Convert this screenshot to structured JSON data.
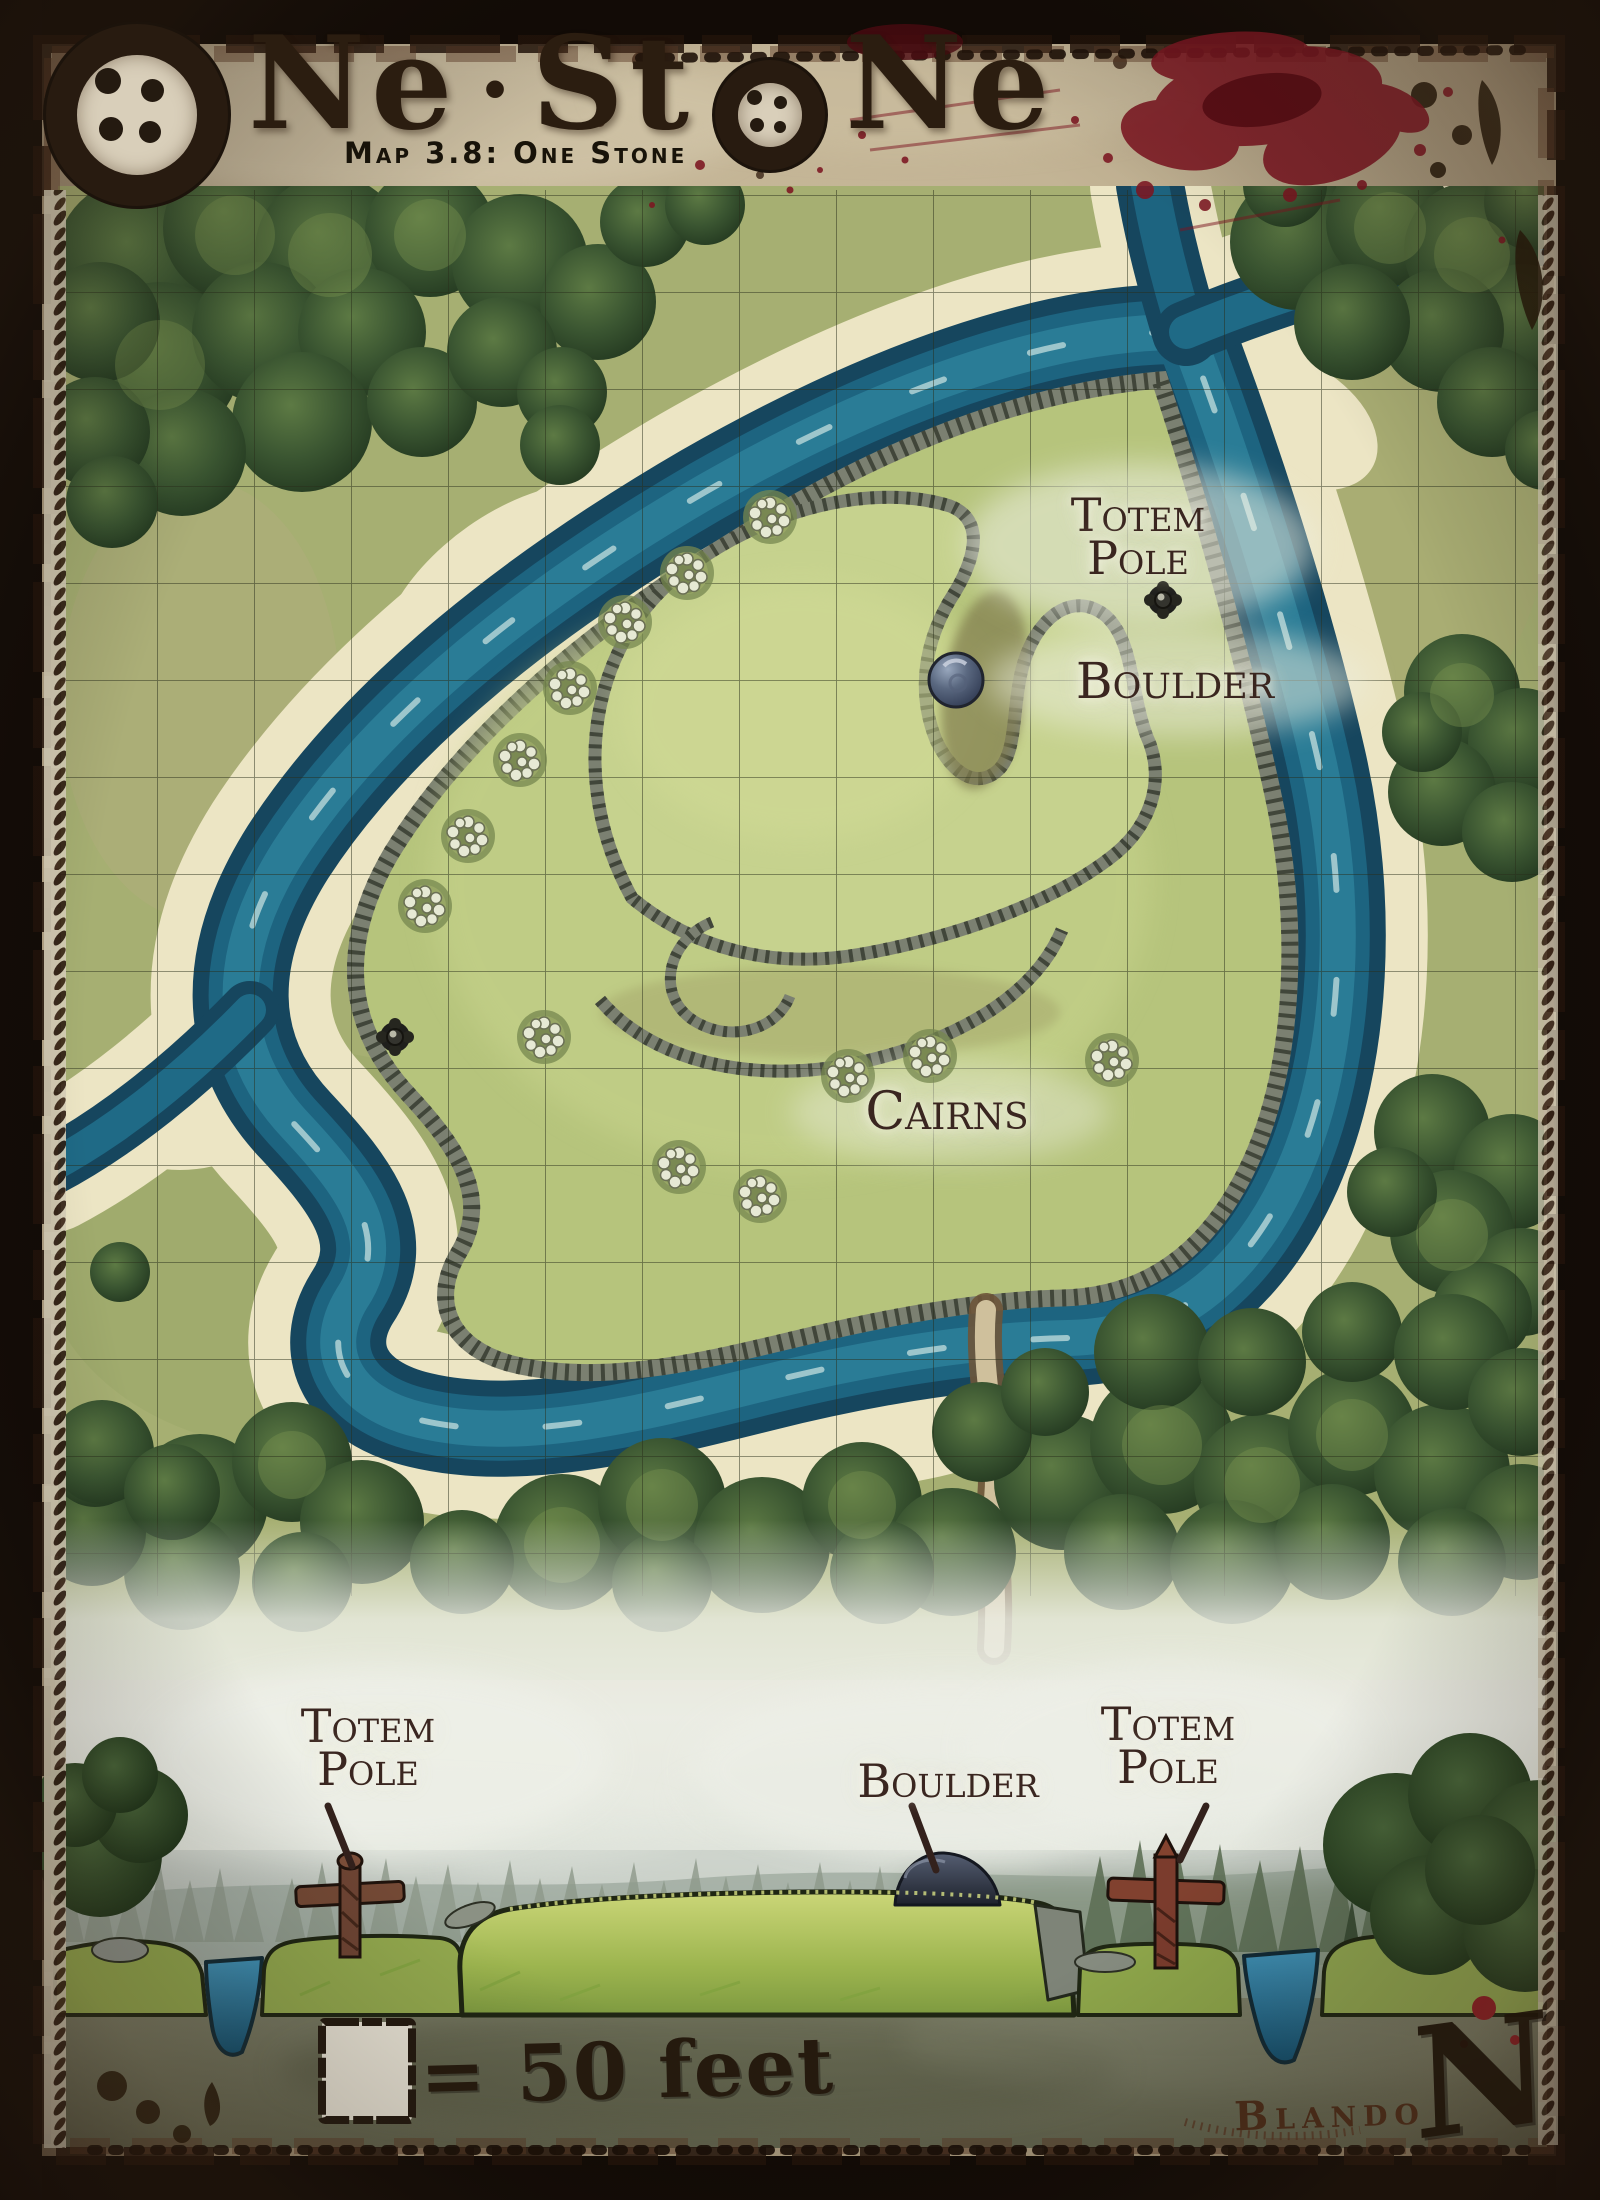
{
  "header": {
    "title_full": "One Stone",
    "title_seg1": "Ne",
    "title_sep": "·",
    "title_seg2": "St",
    "title_seg3": "Ne",
    "subtitle": "Map 3.8: One Stone"
  },
  "map": {
    "labels": {
      "totem_pole_top": {
        "line1": "Totem",
        "line2": "Pole"
      },
      "boulder": "Boulder",
      "cairns": "Cairns"
    },
    "cairn_count": 13,
    "grid_square_feet": 50
  },
  "side_view": {
    "labels": {
      "totem_pole_left": {
        "line1": "Totem",
        "line2": "Pole"
      },
      "boulder": "Boulder",
      "totem_pole_right": {
        "line1": "Totem",
        "line2": "Pole"
      }
    }
  },
  "legend": {
    "scale_text": "= 50 feet"
  },
  "credits": {
    "signature": "Blando"
  },
  "compass": {
    "north_label": "N"
  },
  "colors": {
    "river_deep": "#16465e",
    "river_mid": "#1d6480",
    "river_light": "#2c7e98",
    "sand": "#ece5c4",
    "field_green": "#a8b173",
    "hill_green": "#b6c47c",
    "plateau_green": "#c6d28e",
    "forest_green": "#2f4a2c",
    "parchment": "#c7bb9d",
    "frame_brown": "#150e09",
    "label_ink": "#3a2822",
    "blood_red": "#7c1621"
  }
}
